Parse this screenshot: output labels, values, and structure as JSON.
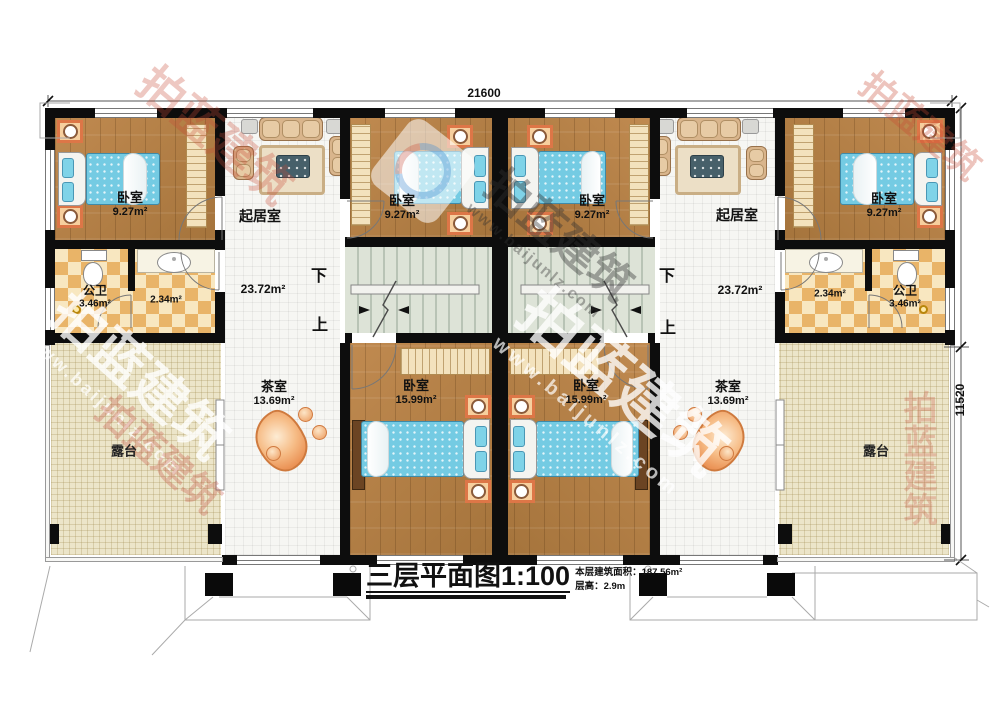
{
  "plan": {
    "dimensions": {
      "top": "21600",
      "right": "11520"
    },
    "stairs": {
      "down": "下",
      "up": "上"
    },
    "rooms": {
      "bedroom_small": {
        "name": "卧室",
        "area": "9.27m²"
      },
      "bedroom_large": {
        "name": "卧室",
        "area": "15.99m²"
      },
      "living": {
        "name": "起居室",
        "area": "23.72m²"
      },
      "bath": {
        "name": "公卫",
        "area": "3.46m²"
      },
      "wash": {
        "area": "2.34m²"
      },
      "tea": {
        "name": "茶室",
        "area": "13.69m²"
      },
      "terrace": {
        "name": "露台"
      }
    },
    "title": {
      "main": "三层平面图",
      "scale": "1:100",
      "area_label": "本层建筑面积：",
      "area_value": "187.56m²",
      "floor_height_label": "层高：",
      "floor_height_value": "2.9m"
    },
    "watermark": {
      "brand": "拍蓝建筑",
      "url": "www.baijunlz.com"
    }
  }
}
